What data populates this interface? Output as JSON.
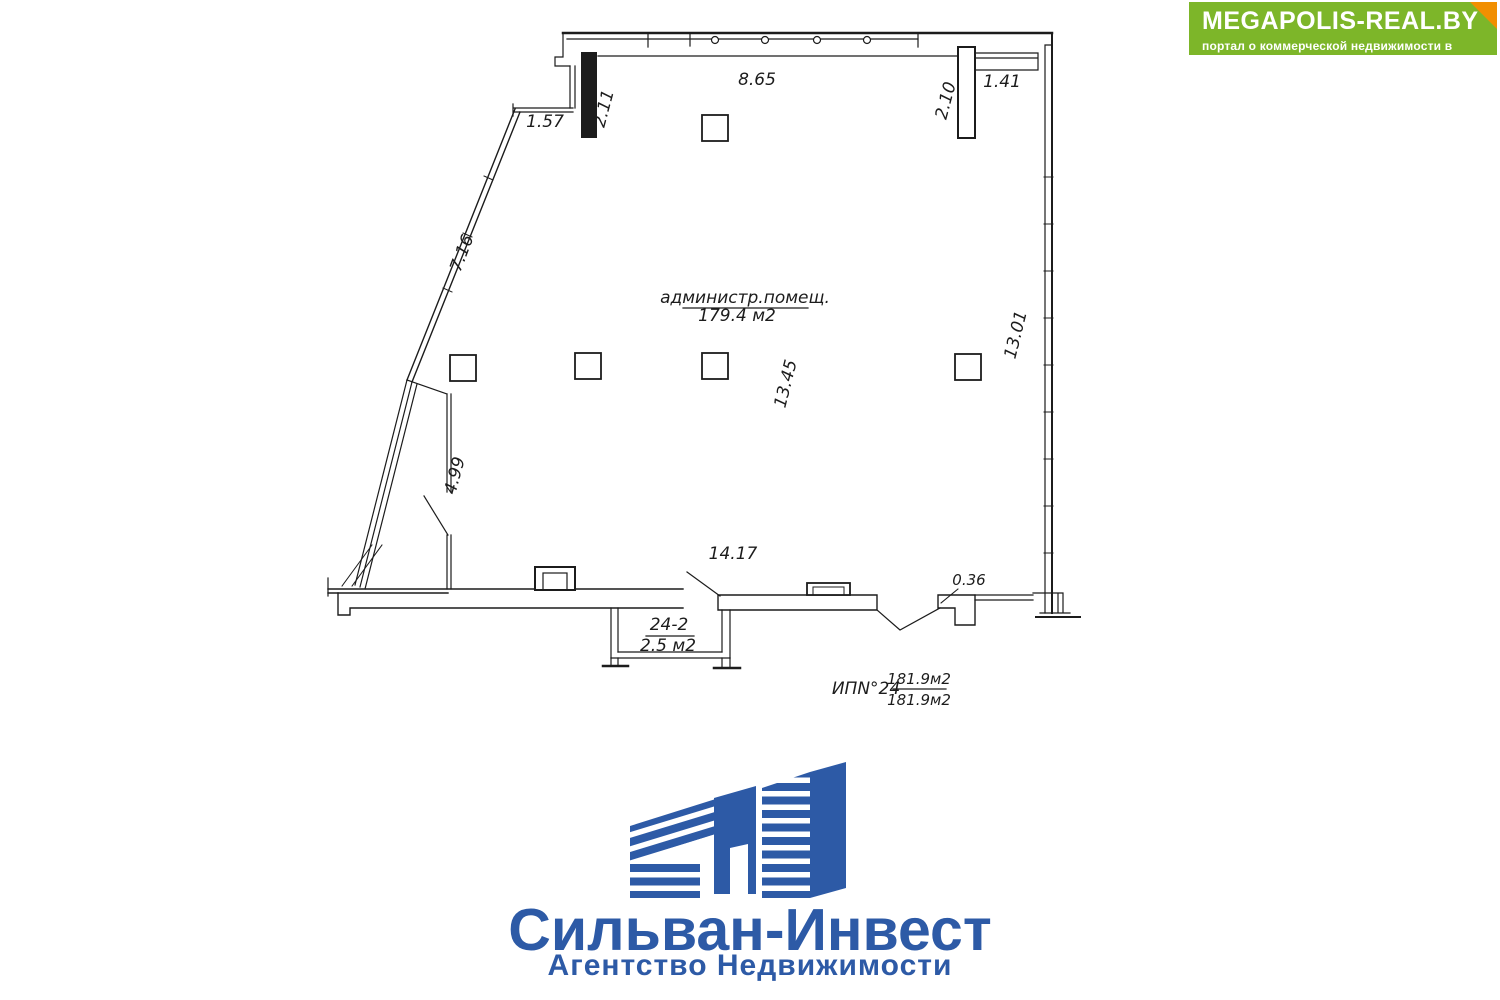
{
  "banner": {
    "title": "MEGAPOLIS-REAL.BY",
    "subtitle": "портал о коммерческой недвижимости в Беларуси"
  },
  "plan": {
    "room": {
      "label": "администр.помещ.",
      "area": "179.4 м2"
    },
    "vestibule": {
      "number": "24-2",
      "area": "2.5 м2"
    },
    "total": {
      "label": "ИПN°24",
      "area_top": "181.9м2",
      "area_bottom": "181.9м2"
    },
    "dimensions": {
      "top_window_width": "8.65",
      "top_right_extension": "1.41",
      "left_pier": "2.11",
      "right_pier": "2.10",
      "top_left_segment": "1.57",
      "diagonal_wall": "7.16",
      "partition_wall": "4.99",
      "hall_depth": "13.45",
      "right_wall": "13.01",
      "bottom_width": "14.17",
      "bottom_ledge": "0.36"
    }
  },
  "logo": {
    "title": "Сильван-Инвест",
    "subtitle": "Агентство Недвижимости"
  },
  "colors": {
    "ink": "#1c1c1c",
    "logo_blue": "#2d5aa6",
    "banner_green": "#7db629",
    "banner_orange": "#f18f01"
  }
}
